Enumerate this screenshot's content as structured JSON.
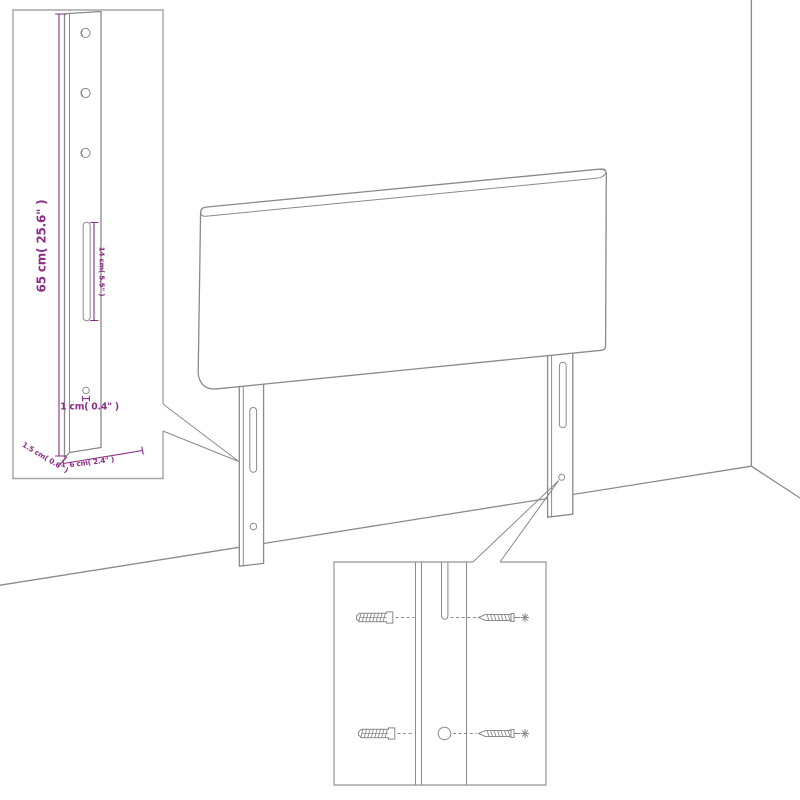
{
  "colors": {
    "background": "#ffffff",
    "line": "#8a8a8a",
    "inset_border": "#a6a6a6",
    "dimension": "#8c2d86"
  },
  "insets": {
    "strut_detail": {
      "labels": {
        "height": "65 cm( 25.6\" )",
        "slot_length": "14 cm( 5.5\" )",
        "hole_diameter": "1 cm( 0.4\" )",
        "thickness": "1.5 cm( 0.6\" )",
        "width": "6 cm( 2.4\" )"
      }
    }
  }
}
